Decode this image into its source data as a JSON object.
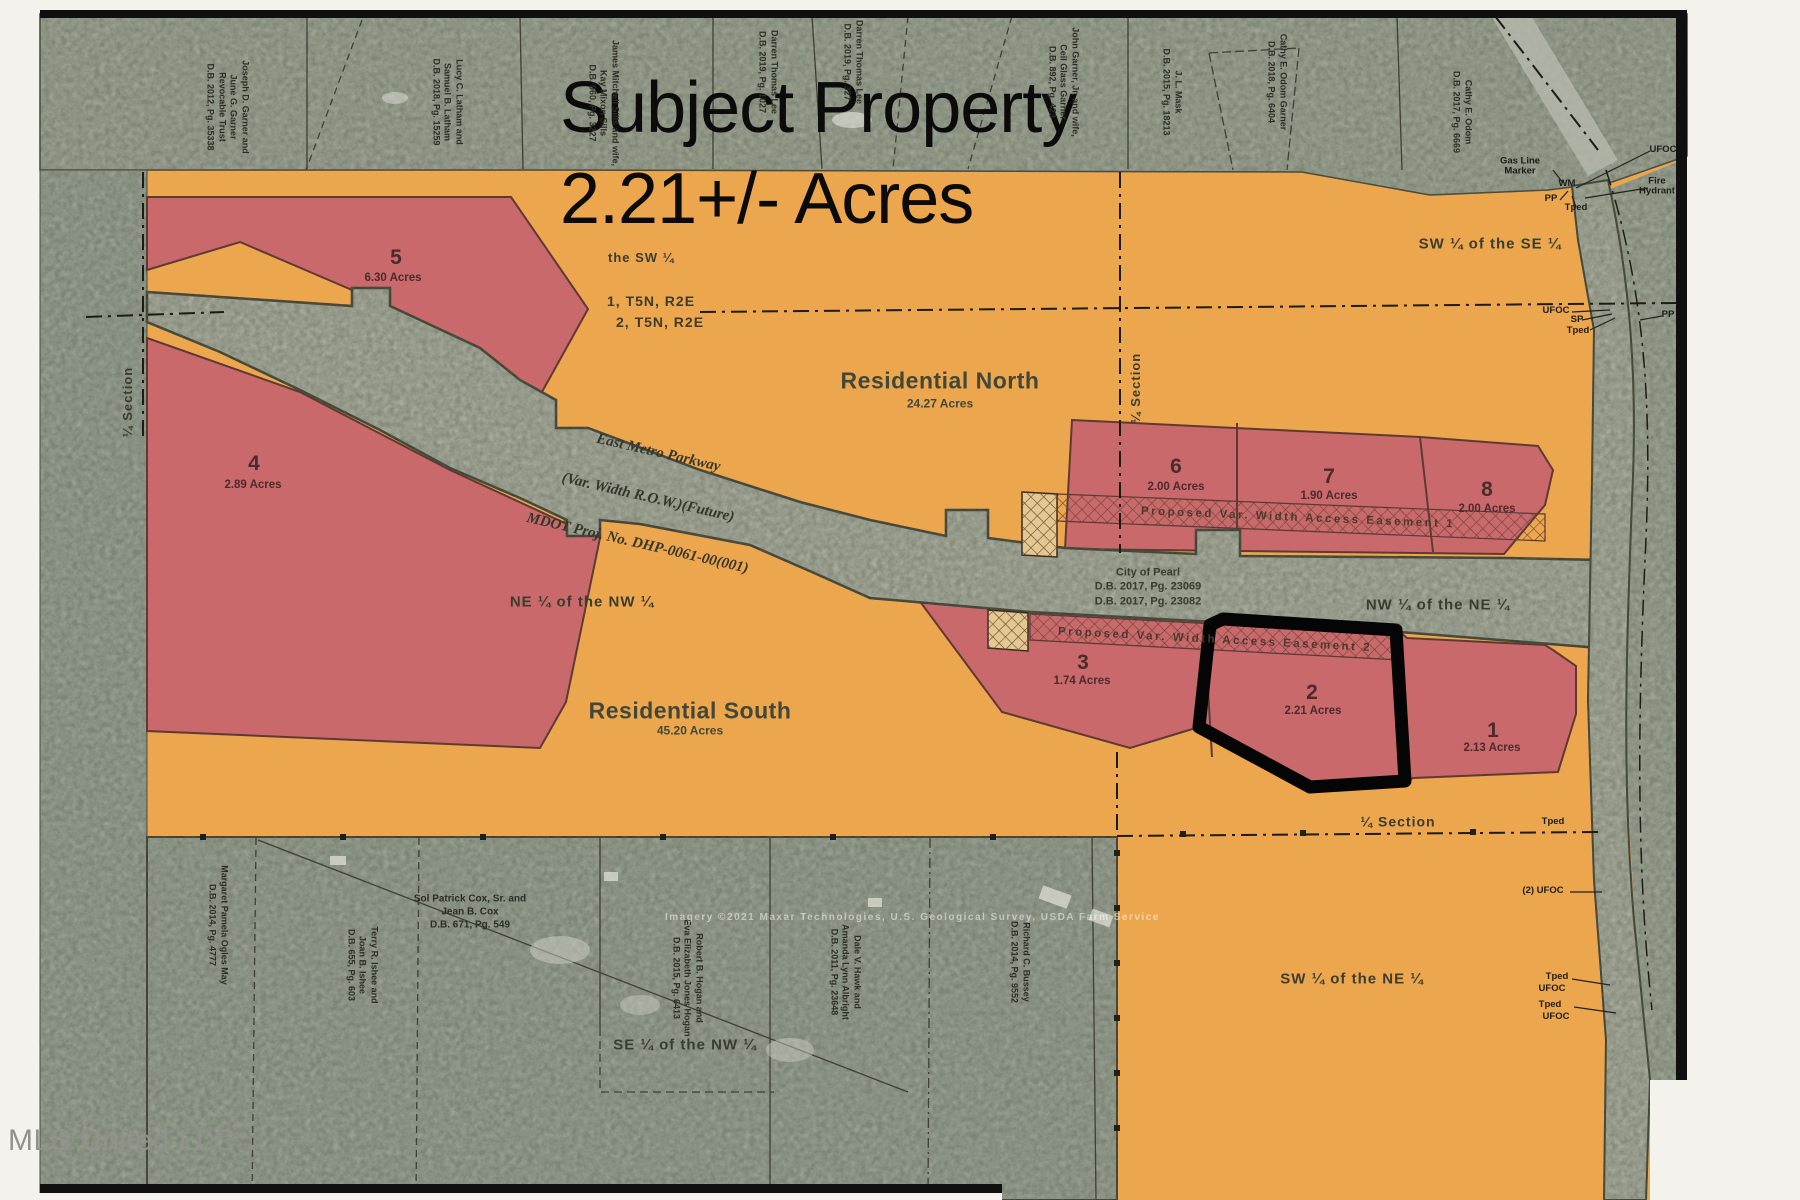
{
  "annotation": {
    "title_line1": "Subject Property",
    "title_line2": "2.21+/- Acres"
  },
  "watermark": "MLS United LLC",
  "imagery_credit": "Imagery ©2021 Maxar Technologies, U.S. Geological Survey, USDA Farm Service",
  "tracts": {
    "north": {
      "name": "Residential North",
      "acres": "24.27 Acres"
    },
    "south": {
      "name": "Residential South",
      "acres": "45.20 Acres"
    }
  },
  "parcels": [
    {
      "num": "1",
      "acres": "2.13 Acres"
    },
    {
      "num": "2",
      "acres": "2.21 Acres"
    },
    {
      "num": "3",
      "acres": "1.74 Acres"
    },
    {
      "num": "4",
      "acres": "2.89 Acres"
    },
    {
      "num": "5",
      "acres": "6.30 Acres"
    },
    {
      "num": "6",
      "acres": "2.00 Acres"
    },
    {
      "num": "7",
      "acres": "1.90 Acres"
    },
    {
      "num": "8",
      "acres": "2.00 Acres"
    }
  ],
  "subject_parcel": "2",
  "road": {
    "line1": "East Metro Parkway",
    "line2": "(Var. Width R.O.W.)(Future)",
    "line3": "MDOT Proj. No. DHP-0061-00(001)"
  },
  "city_note": "City of Pearl\nD.B. 2017, Pg. 23069\nD.B. 2017, Pg. 23082",
  "easements": {
    "e1": "Proposed  Var.  Width  Access  Easement  1",
    "e2": "Proposed  Var.  Width  Access  Easement  2"
  },
  "sections": {
    "sw_label": "the SW ¼",
    "sec1": "1, T5N, R2E",
    "sec2": "2, T5N, R2E"
  },
  "quarters": {
    "sw_se": "SW ¼ of the SE ¼",
    "ne_nw": "NE ¼ of the NW ¼",
    "nw_ne": "NW ¼ of the NE ¼",
    "se_nw": "SE ¼ of the NW ¼",
    "sw_ne": "SW ¼ of the NE ¼",
    "quarter_section": "¼ Section"
  },
  "owners_top": [
    {
      "text": "Joseph D. Garner and\nJune G. Garner\nRevocable Trust\nD.B. 2012, Pg. 35338"
    },
    {
      "text": "Lucy C. Latham and\nSamuel B. Latham\nD.B. 2018, Pg. 15259"
    },
    {
      "text": "James Mitchell Sills and wife,\nKay Mixon Sills\nD.B. 960, Pg. 3227"
    },
    {
      "text": "Darren Thomas Lee\nD.B. 2019, Pg. 1027"
    },
    {
      "text": "Darren Thomas Lee\nD.B. 2019, Pg. 327"
    },
    {
      "text": "John Garner, Jr. and wife,\nCeil Glass Garner\nD.B. 892, Pg. 423"
    },
    {
      "text": "J. L. Mask\nD.B. 2015, Pg. 18213"
    },
    {
      "text": "Cathy E. Odom Garner\nD.B. 2018, Pg. 6404"
    },
    {
      "text": "Cathy E. Odom\nD.B. 2017, Pg. 6669"
    }
  ],
  "owners_bottom": [
    {
      "text": "Margaret Pamela Ogles May\nD.B. 2014, Pg. 4777"
    },
    {
      "text": "Sol Patrick Cox, Sr. and\nJean B. Cox\nD.B. 671, Pg. 549"
    },
    {
      "text": "Terry R. Ishee and\nJoan B. Ishee\nD.B. 655, Pg. 603"
    },
    {
      "text": "Robert B. Hogan and\nEva Elizabeth Jones Hogan\nD.B. 2015, Pg. 6413"
    },
    {
      "text": "Dale V. Hawk and\nAmanda Lynn Albright\nD.B. 2011, Pg. 23648"
    },
    {
      "text": "Richard C. Bussey\nD.B. 2014, Pg. 9552"
    }
  ],
  "utilities": {
    "gas": "Gas Line\nMarker",
    "wm": "WM",
    "pp": "PP",
    "tped": "Tped",
    "ufoc": "UFOC",
    "fire": "Fire\nHydrant",
    "sp": "SP",
    "ufoc_2": "(2) UFOC"
  },
  "colors": {
    "orange": "#eca64e",
    "parcel_red": "#c9696c",
    "aerial_gray": "#9ea494",
    "road_gray": "#a8ab9c",
    "ink": "#121212"
  }
}
